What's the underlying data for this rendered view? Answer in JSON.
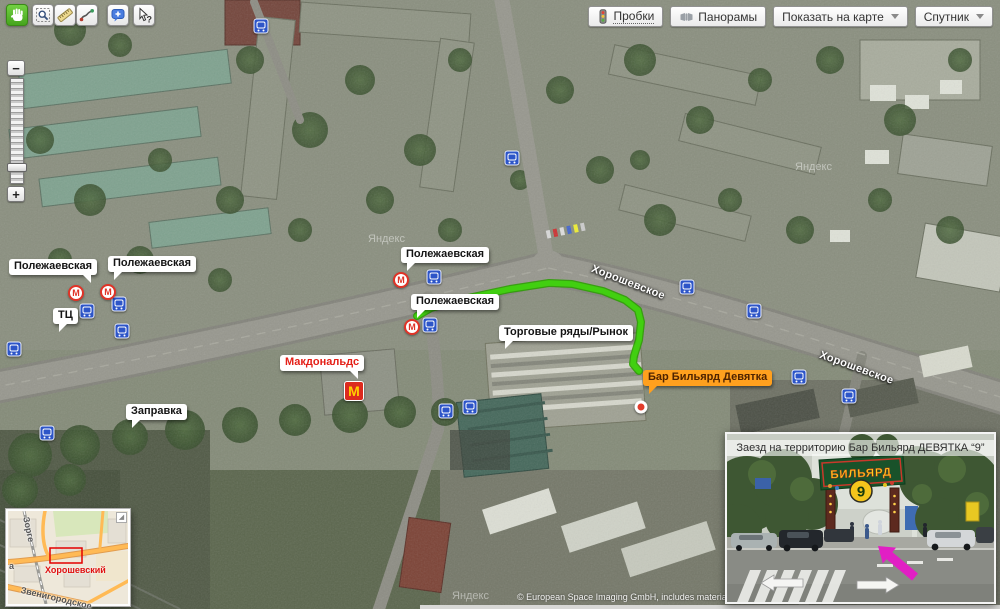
{
  "header": {
    "tools": [
      {
        "name": "pan-tool",
        "icon": "hand-icon",
        "active": true
      },
      {
        "name": "zoom-select-tool",
        "icon": "magnifier-select-icon",
        "active": false
      },
      {
        "name": "measure-tool",
        "icon": "ruler-icon",
        "active": false
      },
      {
        "name": "route-tool",
        "icon": "route-icon",
        "active": false
      },
      {
        "name": "comment-tool",
        "icon": "comment-plus-icon",
        "active": false
      },
      {
        "name": "whats-here-tool",
        "icon": "help-cursor-icon",
        "active": false
      }
    ],
    "buttons": {
      "traffic": "Пробки",
      "panoramas": "Панорамы",
      "show_on_map": "Показать на карте",
      "layer": "Спутник"
    }
  },
  "zoom_control": {
    "minus": "−",
    "plus": "+"
  },
  "map": {
    "callouts": [
      {
        "name": "polezhaevskaya-label-1",
        "text": "Полежаевская",
        "x": 9,
        "y": 259,
        "style": "plain",
        "tail": "br"
      },
      {
        "name": "polezhaevskaya-label-2",
        "text": "Полежаевская",
        "x": 108,
        "y": 256,
        "style": "plain",
        "tail": "bl"
      },
      {
        "name": "polezhaevskaya-label-3",
        "text": "Полежаевская",
        "x": 401,
        "y": 247,
        "style": "plain",
        "tail": "bl"
      },
      {
        "name": "polezhaevskaya-label-4",
        "text": "Полежаевская",
        "x": 411,
        "y": 294,
        "style": "plain",
        "tail": "bl"
      },
      {
        "name": "shopping-center-label",
        "text": "ТЦ",
        "x": 53,
        "y": 308,
        "style": "plain",
        "tail": "bl"
      },
      {
        "name": "gas-station-label",
        "text": "Заправка",
        "x": 126,
        "y": 404,
        "style": "plain",
        "tail": "bl"
      },
      {
        "name": "market-rows-label",
        "text": "Торговые ряды/Рынок",
        "x": 499,
        "y": 325,
        "style": "plain",
        "tail": "bl"
      },
      {
        "name": "mcdonalds-label",
        "text": "Макдональдс",
        "x": 280,
        "y": 355,
        "style": "red",
        "tail": "br"
      },
      {
        "name": "bar-billiard-label",
        "text": "Бар Бильярд Девятка",
        "x": 643,
        "y": 370,
        "style": "orange",
        "tail": "bl"
      }
    ],
    "street_labels": [
      {
        "text": "Хорошевское",
        "x": 594,
        "y": 263,
        "angle": 21
      },
      {
        "text": "Хорошевское",
        "x": 822,
        "y": 349,
        "angle": 20
      }
    ],
    "metro_letter": "М",
    "metro_markers": [
      {
        "x": 76,
        "y": 293
      },
      {
        "x": 108,
        "y": 292
      },
      {
        "x": 401,
        "y": 280
      },
      {
        "x": 412,
        "y": 327
      }
    ],
    "transport_markers": [
      {
        "x": 261,
        "y": 26
      },
      {
        "x": 512,
        "y": 158
      },
      {
        "x": 87,
        "y": 311
      },
      {
        "x": 119,
        "y": 304
      },
      {
        "x": 122,
        "y": 331
      },
      {
        "x": 14,
        "y": 349
      },
      {
        "x": 47,
        "y": 433
      },
      {
        "x": 434,
        "y": 277
      },
      {
        "x": 430,
        "y": 325
      },
      {
        "x": 687,
        "y": 287
      },
      {
        "x": 754,
        "y": 311
      },
      {
        "x": 799,
        "y": 377
      },
      {
        "x": 849,
        "y": 396
      },
      {
        "x": 446,
        "y": 411
      },
      {
        "x": 470,
        "y": 407
      }
    ],
    "mcdonalds_marker": {
      "x": 354,
      "y": 391,
      "letter": "M"
    },
    "destination_dot": {
      "x": 641,
      "y": 407
    },
    "route_points": "417,316 431,308 468,298 510,289 549,283 572,284 603,291 625,300 638,310 641,322 639,340 634,356 633,364 639,371",
    "route_color": "#41cf10",
    "route_outline_color": "#2f9e05",
    "watermark_text": "Яндекс",
    "watermarks": [
      {
        "x": 368,
        "y": 233
      },
      {
        "x": 795,
        "y": 161
      },
      {
        "x": 452,
        "y": 590
      }
    ],
    "attribution": "© European Space Imaging GmbH, includes material"
  },
  "minimap": {
    "district_label": "Хорошевский",
    "street_vertical": "Зорге",
    "street_diagonal": "Звенигородское",
    "edge_label": "а",
    "viewport_color": "#e30000"
  },
  "photo": {
    "caption": "Заезд на территорию Бар Бильярд ДЕВЯТКА “9”",
    "sign_title": "БИЛЬЯРД",
    "sign_number": "9",
    "arrow_color": "#e11fc4"
  }
}
